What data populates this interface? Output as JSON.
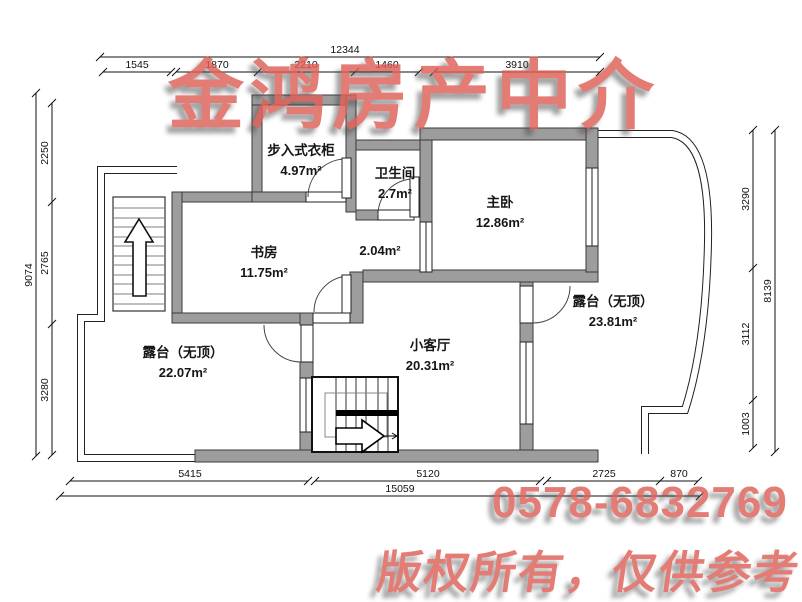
{
  "title": "apartment floor plan",
  "watermarks": {
    "agency": "金鸿房产中介",
    "phone": "0578-6832769",
    "notice": "版权所有，仅供参考",
    "color": "#de6057"
  },
  "dimensions": {
    "top": {
      "total": "12344",
      "segments": [
        "1545",
        "1870",
        "2210",
        "1460",
        "3910"
      ]
    },
    "left": {
      "total": "9074",
      "segments": [
        "2250",
        "2765",
        "3280"
      ]
    },
    "right": {
      "total": "8139",
      "segments": [
        "3290",
        "3112",
        "1003"
      ]
    },
    "bottom": {
      "total": "15059",
      "segments": [
        "5415",
        "5120",
        "2725",
        "870"
      ]
    }
  },
  "rooms": {
    "closet": {
      "name": "步入式衣柜",
      "area": "4.97m²"
    },
    "bath": {
      "name": "卫生间",
      "area": "2.7m²"
    },
    "hall": {
      "name": "",
      "area": "2.04m²"
    },
    "bedroom": {
      "name": "主卧",
      "area": "12.86m²"
    },
    "study": {
      "name": "书房",
      "area": "11.75m²"
    },
    "terraceRight": {
      "name": "露台（无顶）",
      "area": "23.81m²"
    },
    "living": {
      "name": "小客厅",
      "area": "20.31m²"
    },
    "terraceLeft": {
      "name": "露台（无顶）",
      "area": "22.07m²"
    }
  },
  "colors": {
    "wall": "#9d9d9d",
    "line": "#111111"
  }
}
